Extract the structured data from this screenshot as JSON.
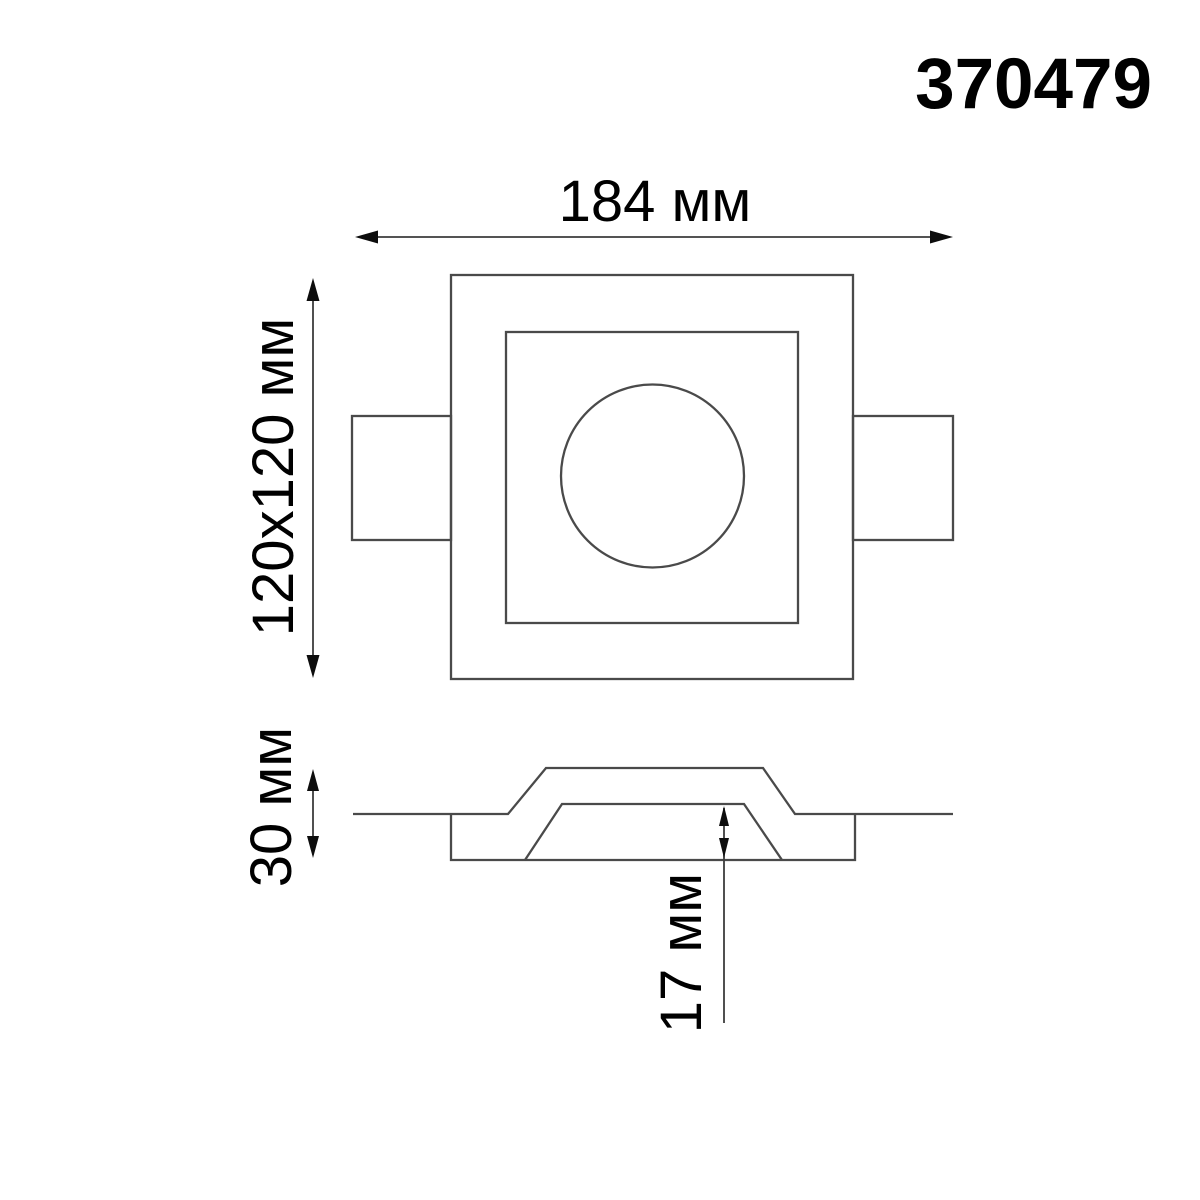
{
  "product_code": "370479",
  "colors": {
    "line": "#4a4a4a",
    "dimension": "#3c3c3c",
    "arrow": "#0d0d0d",
    "text": "#000000",
    "background": "#ffffff"
  },
  "top_view": {
    "overall_width_label": "184 мм",
    "body_size_label": "120х120 мм"
  },
  "section_view": {
    "overall_height_label": "30 мм",
    "recess_depth_label": "17 мм"
  }
}
